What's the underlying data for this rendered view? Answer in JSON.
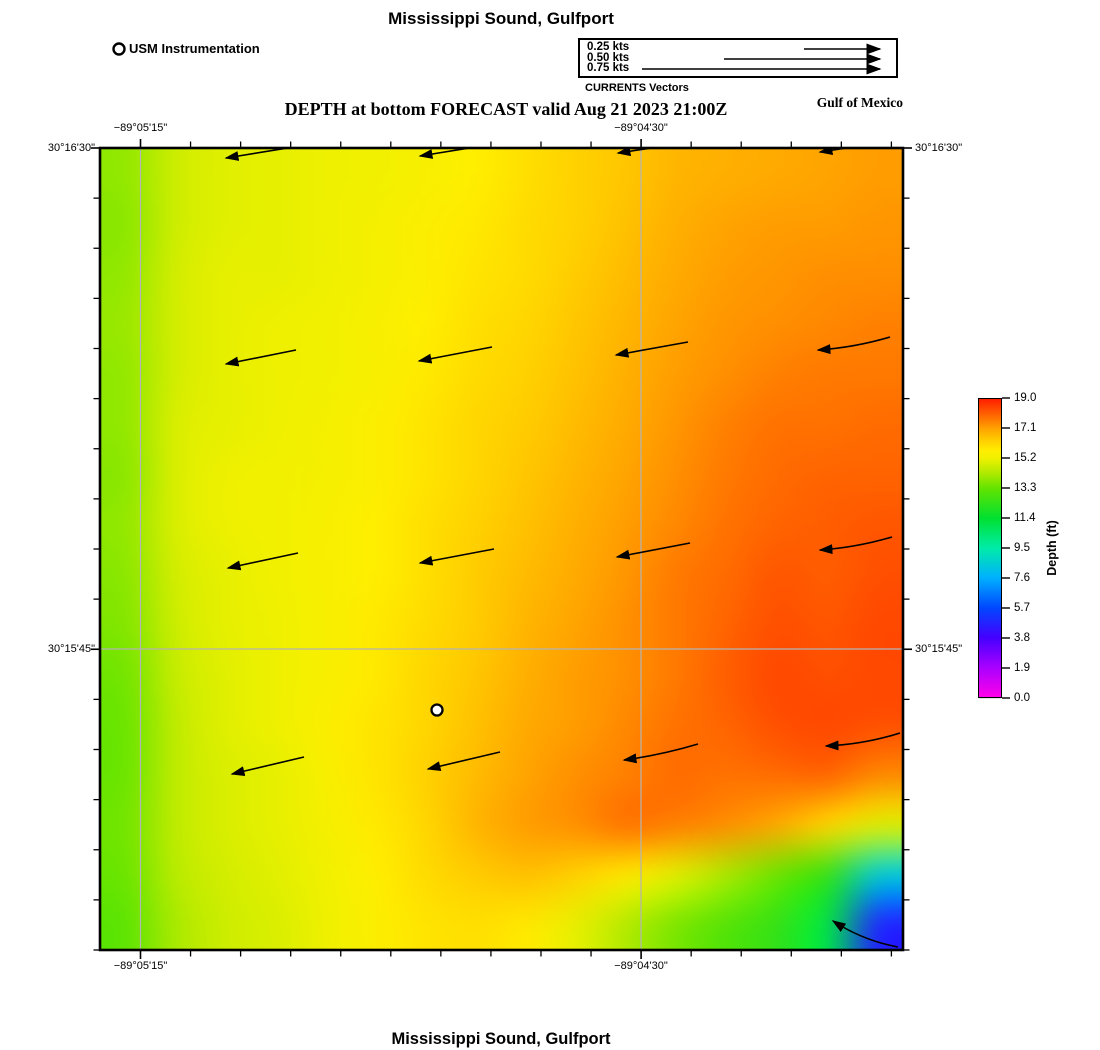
{
  "titles": {
    "top": "Mississippi Sound, Gulfport",
    "subtitle": "DEPTH at bottom FORECAST valid Aug 21 2023 21:00Z",
    "bottom": "Mississippi Sound, Gulfport",
    "region_label": "Gulf of Mexico"
  },
  "station_legend": {
    "label": "USM Instrumentation"
  },
  "vector_legend": {
    "title": "CURRENTS Vectors",
    "entries": [
      {
        "label": "0.25 kts",
        "line_start_x": 802
      },
      {
        "label": "0.50 kts",
        "line_start_x": 722
      },
      {
        "label": "0.75 kts",
        "line_start_x": 640
      }
    ],
    "line_end_x": 878,
    "rows_y": [
      47,
      57,
      67
    ]
  },
  "axes": {
    "top_labels": [
      {
        "text": "−89°05'15\"",
        "x": 140.5
      },
      {
        "text": "−89°04'30\"",
        "x": 641
      }
    ],
    "bottom_labels": [
      {
        "text": "−89°05'15\"",
        "x": 140.5
      },
      {
        "text": "−89°04'30\"",
        "x": 641
      }
    ],
    "left_labels": [
      {
        "text": "30°16'30\"",
        "y": 148
      },
      {
        "text": "30°15'45\"",
        "y": 649
      }
    ],
    "right_labels": [
      {
        "text": "30°16'30\"",
        "y": 148
      },
      {
        "text": "30°15'45\"",
        "y": 649
      }
    ],
    "x_gridlines": [
      140.5,
      641
    ],
    "y_gridlines": [
      649
    ],
    "x_ticks": {
      "start": 140.5,
      "step": 50.06,
      "count": 16,
      "major_indices": [
        0,
        10
      ]
    },
    "y_ticks": {
      "start": 148,
      "step": 50.125,
      "count": 17,
      "major_indices": [
        0,
        10
      ]
    }
  },
  "colorbar": {
    "label": "Depth (ft)",
    "tick_labels": [
      "19.0",
      "17.1",
      "15.2",
      "13.3",
      "11.4",
      "9.5",
      "7.6",
      "5.7",
      "3.8",
      "1.9",
      "0.0"
    ],
    "value_min": 0.0,
    "value_max": 19.0
  },
  "chart_data": {
    "type": "heatmap",
    "title": "DEPTH at bottom FORECAST valid Aug 21 2023 21:00Z",
    "value_label": "Depth (ft)",
    "value_range": [
      0.0,
      19.0
    ],
    "x_axis_labels": [
      "-89°05'15\"",
      "-89°04'30\""
    ],
    "y_axis_labels": [
      "30°16'30\"",
      "30°15'45\""
    ],
    "map_rect_px": {
      "left": 100,
      "top": 148,
      "width": 803,
      "height": 802
    },
    "colormap_stops": [
      [
        0.0,
        "#ff00ea"
      ],
      [
        1.9,
        "#a800ff"
      ],
      [
        3.8,
        "#4400ff"
      ],
      [
        5.7,
        "#0048ff"
      ],
      [
        7.6,
        "#00b0ff"
      ],
      [
        9.5,
        "#00eca8"
      ],
      [
        11.4,
        "#00e030"
      ],
      [
        13.3,
        "#62e400"
      ],
      [
        14.3,
        "#b2ea00"
      ],
      [
        15.2,
        "#eef000"
      ],
      [
        15.7,
        "#ffee00"
      ],
      [
        16.4,
        "#ffcc00"
      ],
      [
        17.1,
        "#ffa400"
      ],
      [
        18.0,
        "#ff6400"
      ],
      [
        19.0,
        "#ff1e00"
      ]
    ],
    "depth_grid_ft": [
      [
        13.9,
        14.7,
        15.0,
        15.1,
        15.2,
        15.3,
        15.5,
        15.7,
        16.0,
        16.3,
        16.5,
        16.8,
        16.9,
        17.0,
        17.1,
        17.2
      ],
      [
        13.8,
        14.7,
        15.0,
        15.1,
        15.2,
        15.4,
        15.6,
        15.8,
        16.1,
        16.3,
        16.6,
        16.9,
        17.1,
        17.2,
        17.2,
        17.3
      ],
      [
        13.9,
        14.8,
        15.1,
        15.1,
        15.2,
        15.4,
        15.6,
        15.9,
        16.1,
        16.4,
        16.7,
        17.0,
        17.2,
        17.3,
        17.4,
        17.4
      ],
      [
        14.0,
        14.8,
        15.1,
        15.2,
        15.3,
        15.5,
        15.7,
        16.0,
        16.2,
        16.5,
        16.8,
        17.1,
        17.3,
        17.4,
        17.5,
        17.6
      ],
      [
        13.9,
        14.8,
        15.1,
        15.2,
        15.3,
        15.5,
        15.8,
        16.1,
        16.3,
        16.6,
        16.9,
        17.2,
        17.4,
        17.6,
        17.7,
        17.7
      ],
      [
        13.9,
        14.9,
        15.1,
        15.2,
        15.4,
        15.6,
        15.9,
        16.2,
        16.4,
        16.7,
        17.0,
        17.3,
        17.6,
        17.8,
        17.8,
        17.9
      ],
      [
        13.8,
        14.9,
        15.2,
        15.3,
        15.4,
        15.6,
        15.9,
        16.2,
        16.5,
        16.8,
        17.1,
        17.4,
        17.7,
        17.9,
        18.0,
        18.0
      ],
      [
        13.9,
        14.9,
        15.2,
        15.3,
        15.5,
        15.7,
        16.0,
        16.3,
        16.6,
        16.9,
        17.2,
        17.5,
        17.8,
        18.0,
        18.1,
        18.2
      ],
      [
        13.8,
        14.8,
        15.1,
        15.3,
        15.5,
        15.7,
        16.0,
        16.4,
        16.7,
        17.0,
        17.3,
        17.7,
        17.9,
        18.2,
        18.1,
        18.3
      ],
      [
        13.7,
        14.7,
        15.1,
        15.2,
        15.5,
        15.8,
        16.1,
        16.4,
        16.8,
        17.1,
        17.4,
        17.7,
        18.0,
        18.3,
        18.2,
        18.4
      ],
      [
        13.5,
        14.6,
        15.0,
        15.2,
        15.5,
        15.8,
        16.2,
        16.5,
        16.9,
        17.2,
        17.4,
        17.7,
        18.1,
        18.4,
        18.3,
        18.4
      ],
      [
        13.4,
        14.5,
        15.0,
        15.2,
        15.6,
        15.9,
        16.2,
        16.6,
        17.0,
        17.2,
        17.5,
        17.8,
        18.0,
        18.3,
        18.4,
        18.3
      ],
      [
        13.4,
        14.5,
        14.9,
        15.1,
        15.5,
        15.9,
        16.3,
        16.7,
        17.1,
        17.4,
        17.6,
        17.9,
        17.8,
        17.9,
        18.0,
        17.5
      ],
      [
        13.5,
        14.5,
        14.9,
        15.1,
        15.4,
        15.8,
        16.2,
        16.8,
        17.2,
        17.4,
        17.8,
        17.6,
        17.4,
        17.0,
        16.2,
        15.0
      ],
      [
        13.4,
        14.4,
        14.8,
        15.0,
        15.3,
        15.7,
        16.1,
        16.4,
        16.6,
        16.3,
        15.8,
        15.0,
        14.2,
        13.4,
        12.4,
        8.5
      ],
      [
        13.2,
        14.2,
        14.7,
        14.9,
        15.2,
        15.6,
        15.9,
        16.0,
        15.8,
        15.1,
        14.3,
        13.6,
        13.0,
        12.4,
        11.0,
        4.8
      ]
    ],
    "current_vectors_px": [
      {
        "tail": [
          300,
          146
        ],
        "tip": [
          226,
          158
        ]
      },
      {
        "tail": [
          494,
          144
        ],
        "tip": [
          420,
          156
        ]
      },
      {
        "tail": [
          692,
          142
        ],
        "tip": [
          618,
          153
        ]
      },
      {
        "tail": [
          893,
          141
        ],
        "tip": [
          820,
          152
        ]
      },
      {
        "tail": [
          296,
          350
        ],
        "tip": [
          226,
          364
        ]
      },
      {
        "tail": [
          492,
          347
        ],
        "tip": [
          419,
          361
        ]
      },
      {
        "tail": [
          688,
          342
        ],
        "tip": [
          616,
          355
        ]
      },
      {
        "tail": [
          890,
          337
        ],
        "tip": [
          818,
          350
        ],
        "bend": -4
      },
      {
        "tail": [
          298,
          553
        ],
        "tip": [
          228,
          568
        ]
      },
      {
        "tail": [
          494,
          549
        ],
        "tip": [
          420,
          563
        ]
      },
      {
        "tail": [
          690,
          543
        ],
        "tip": [
          617,
          557
        ]
      },
      {
        "tail": [
          892,
          537
        ],
        "tip": [
          820,
          550
        ],
        "bend": -4
      },
      {
        "tail": [
          304,
          757
        ],
        "tip": [
          232,
          774
        ]
      },
      {
        "tail": [
          500,
          752
        ],
        "tip": [
          428,
          769
        ]
      },
      {
        "tail": [
          698,
          744
        ],
        "tip": [
          624,
          760
        ],
        "bend": -3
      },
      {
        "tail": [
          900,
          733
        ],
        "tip": [
          826,
          746
        ],
        "bend": -5
      },
      {
        "tail": [
          898,
          947
        ],
        "tip": [
          833,
          921
        ],
        "bend": -7
      }
    ],
    "station_marker_px": {
      "x": 437,
      "y": 710
    },
    "grid_color": "#b4b4b4",
    "vector_color": "#000000"
  }
}
